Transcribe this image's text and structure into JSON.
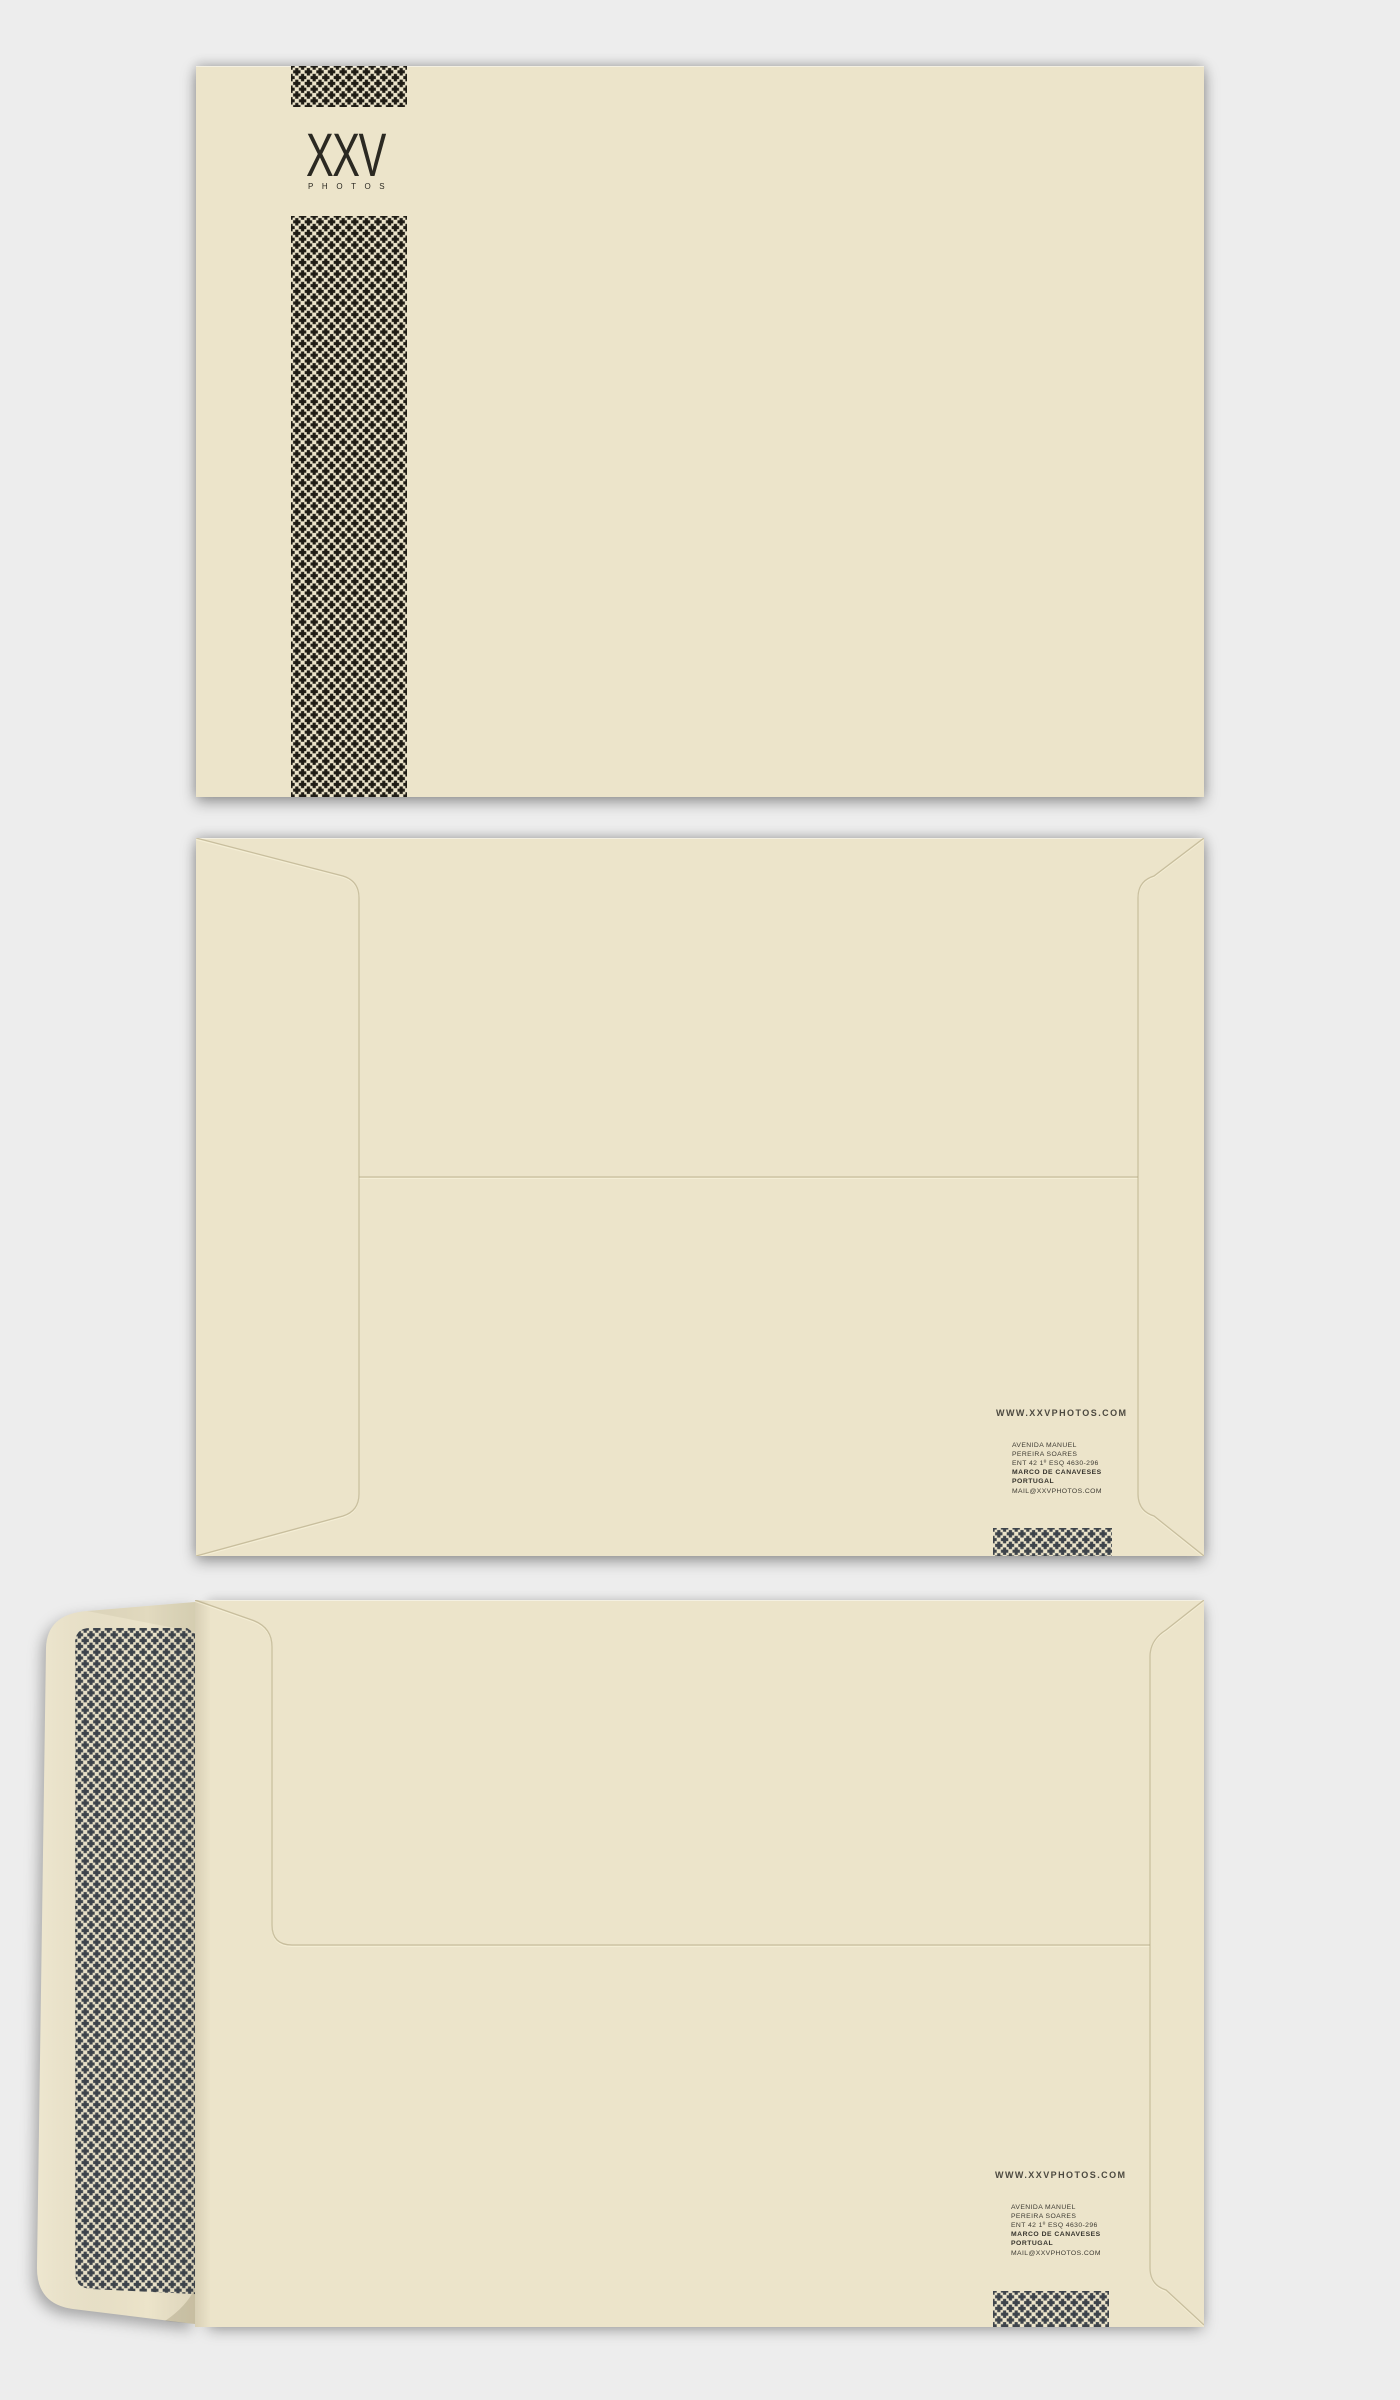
{
  "brand": {
    "logo_text": "XXV",
    "logo_subtext": "PHOTOS",
    "website": "WWW.XXVPHOTOS.COM",
    "address_lines": [
      "AVENIDA MANUEL",
      "PEREIRA SOARES",
      "ENT 42 1º ESQ 4630-296",
      "MARCO DE CANAVESES",
      "PORTUGAL"
    ],
    "email": "MAIL@XXVPHOTOS.COM"
  },
  "colors": {
    "background": "#ededed",
    "envelope_paper": "#ece4ca",
    "front_halftone_dots": "#201d16",
    "back_halftone_dots": "#3e444b",
    "logo_ink": "#2b2922",
    "contact_text": "#3e3b33"
  }
}
